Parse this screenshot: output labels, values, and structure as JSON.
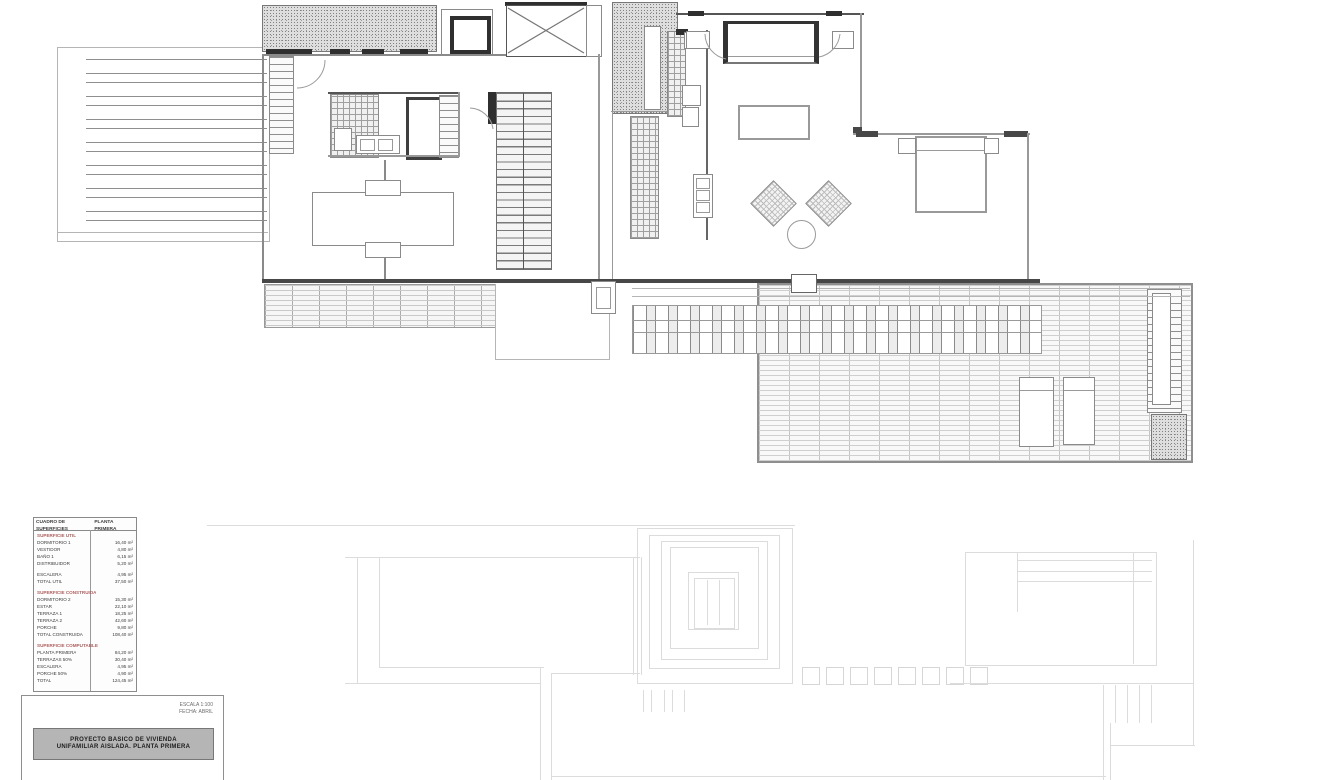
{
  "drawing": {
    "type": "architectural-floor-plan-upper-level",
    "colors": {
      "wall_dark": "#474747",
      "line_mid": "#8a8a8a",
      "line_faint": "#dcdcdc",
      "legend_red": "#b06060",
      "banner_bg": "#b5b5b5"
    }
  },
  "legend": {
    "header_left": "CUADRO DE SUPERFICIES",
    "header_right": "PLANTA PRIMERA",
    "rows": [
      {
        "l": "SUPERFICIE UTIL",
        "v": "",
        "t": "red"
      },
      {
        "l": "DORMITORIO 1",
        "v": "16,40 m²",
        "t": "item"
      },
      {
        "l": "VESTIDOR",
        "v": "4,80 m²",
        "t": "item"
      },
      {
        "l": "BAÑO 1",
        "v": "6,15 m²",
        "t": "item"
      },
      {
        "l": "DISTRIBUIDOR",
        "v": "5,20 m²",
        "t": "item"
      },
      {
        "l": "",
        "v": "",
        "t": "sp"
      },
      {
        "l": "ESCALERA",
        "v": "4,95 m²",
        "t": "item"
      },
      {
        "l": "TOTAL UTIL",
        "v": "37,50 m²",
        "t": "item"
      },
      {
        "l": "",
        "v": "",
        "t": "sp"
      },
      {
        "l": "SUPERFICIE CONSTRUIDA",
        "v": "",
        "t": "red"
      },
      {
        "l": "DORMITORIO 2",
        "v": "15,30 m²",
        "t": "item"
      },
      {
        "l": "ESTAR",
        "v": "22,10 m²",
        "t": "item"
      },
      {
        "l": "TERRAZA 1",
        "v": "18,25 m²",
        "t": "item"
      },
      {
        "l": "TERRAZA 2",
        "v": "42,60 m²",
        "t": "item"
      },
      {
        "l": "PORCHE",
        "v": "9,80 m²",
        "t": "item"
      },
      {
        "l": "TOTAL CONSTRUIDA",
        "v": "108,40 m²",
        "t": "item"
      },
      {
        "l": "",
        "v": "",
        "t": "sp"
      },
      {
        "l": "SUPERFICIE COMPUTABLE",
        "v": "",
        "t": "red"
      },
      {
        "l": "PLANTA PRIMERA",
        "v": "84,20 m²",
        "t": "item"
      },
      {
        "l": "TERRAZAS 50%",
        "v": "30,40 m²",
        "t": "item"
      },
      {
        "l": "ESCALERA",
        "v": "4,95 m²",
        "t": "item"
      },
      {
        "l": "PORCHE 50%",
        "v": "4,90 m²",
        "t": "item"
      },
      {
        "l": "TOTAL",
        "v": "124,45 m²",
        "t": "item"
      }
    ]
  },
  "title_block": {
    "note_line1": "ESCALA 1:100",
    "note_line2": "FECHA: ABRIL",
    "banner_line1": "PROYECTO BASICO DE VIVIENDA",
    "banner_line2": "UNIFAMILIAR AISLADA. PLANTA PRIMERA"
  }
}
